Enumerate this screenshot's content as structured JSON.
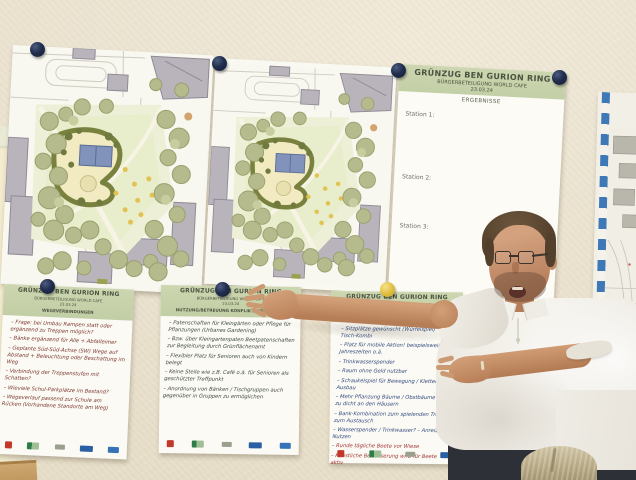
{
  "results_poster": {
    "title": "GRÜNZUG BEN GURION RING",
    "subtitle": "BÜRGERBETEILIGUNG WORLD CAFE",
    "date": "23.03.24",
    "section_label": "ERGEBNISSE",
    "stations": [
      "Station 1:",
      "Station 2:",
      "Station 3:"
    ]
  },
  "flipcharts": [
    {
      "title": "GRÜNZUG BEN GURION RING",
      "subtitle": "BÜRGERBETEILIGUNG WORLD CAFE",
      "date": "23.03.24",
      "topic": "WEGEVERBINDUNGEN",
      "ink": "#7c362f",
      "notes": [
        "Frage: bei Umbau Rampen statt oder ergänzend zu Treppen möglich?",
        "Bänke ergänzend für Alle + Abfalleimer",
        "Geplante Süd-Süd-Achse (SW) Wege auf Abstand + Beleuchtung oder Beschattung im Weg",
        "Verbindung der Treppenstufen mit Schatten?",
        "Wieviele Schul-Parkplätze im Bestand?",
        "Wegeverlauf passend zur Schule am Rücken (Vorhandene Standorte am Weg)"
      ]
    },
    {
      "title": "GRÜNZUG BEN GURION RING",
      "subtitle": "BÜRGERBETEILIGUNG WORLD CAFE",
      "date": "23.03.24",
      "topic": "NUTZUNG/BETREUUNG KONFLIKTVERMEIDUNG",
      "ink": "#3d473d",
      "notes": [
        "Patenschaften für Kleingärten oder Pflege für Pflanzungen (Urbanes Gardening)",
        "Bzw. über Kleingartenpaten Beetpatenschaften zur Begleitung durch Grünflächenamt",
        "Flexibler Platz für Senioren auch von Kindern belegt",
        "Keine Stelle wie z.B. Café o.ä. für Senioren als geschützter Treffpunkt",
        "Anordnung von Bänken / Tischgruppen auch gegenüber in Gruppen zu ermöglichen"
      ]
    },
    {
      "title": "GRÜNZUG BEN GURION RING",
      "subtitle": "BÜRGERBETEILIGUNG WORLD CAFE",
      "date": "23.03.24",
      "topic": "",
      "ink": "#30497e",
      "notes": [
        "Sitzplätze gewünscht (Würfelspiel) = Bank-Tisch-Kombi",
        "Platz für mobile Aktion! beispielsweise 4 Jahreszeiten o.ä.",
        "Trinkwasserspender",
        "Raum ohne Geld nutzbar",
        "Schaukelspiel für Bewegung / Klettern – Ausbau",
        "Mehr Pflanzung Bäume / Obstbäume – nicht zu dicht an den Häusern",
        "Bank-Kombination zum spielenden Treffen zum Austausch",
        "Wasserspender / Trinkwasser? – Anreiz zum Nutzen",
        {
          "text": "Runde tägliche Beete vor Wiese",
          "color": "#a23434"
        },
        {
          "text": "Künstliche Bewässerung wird für Beete aktiv",
          "color": "#a23434"
        }
      ]
    }
  ],
  "colors": {
    "wall": "#ebe3d0",
    "poster_header_green": "#c7d2ab",
    "pin_navy": "#1c2947",
    "pin_yellow": "#ddb937",
    "map_tape_blue": "#3e78b6"
  }
}
